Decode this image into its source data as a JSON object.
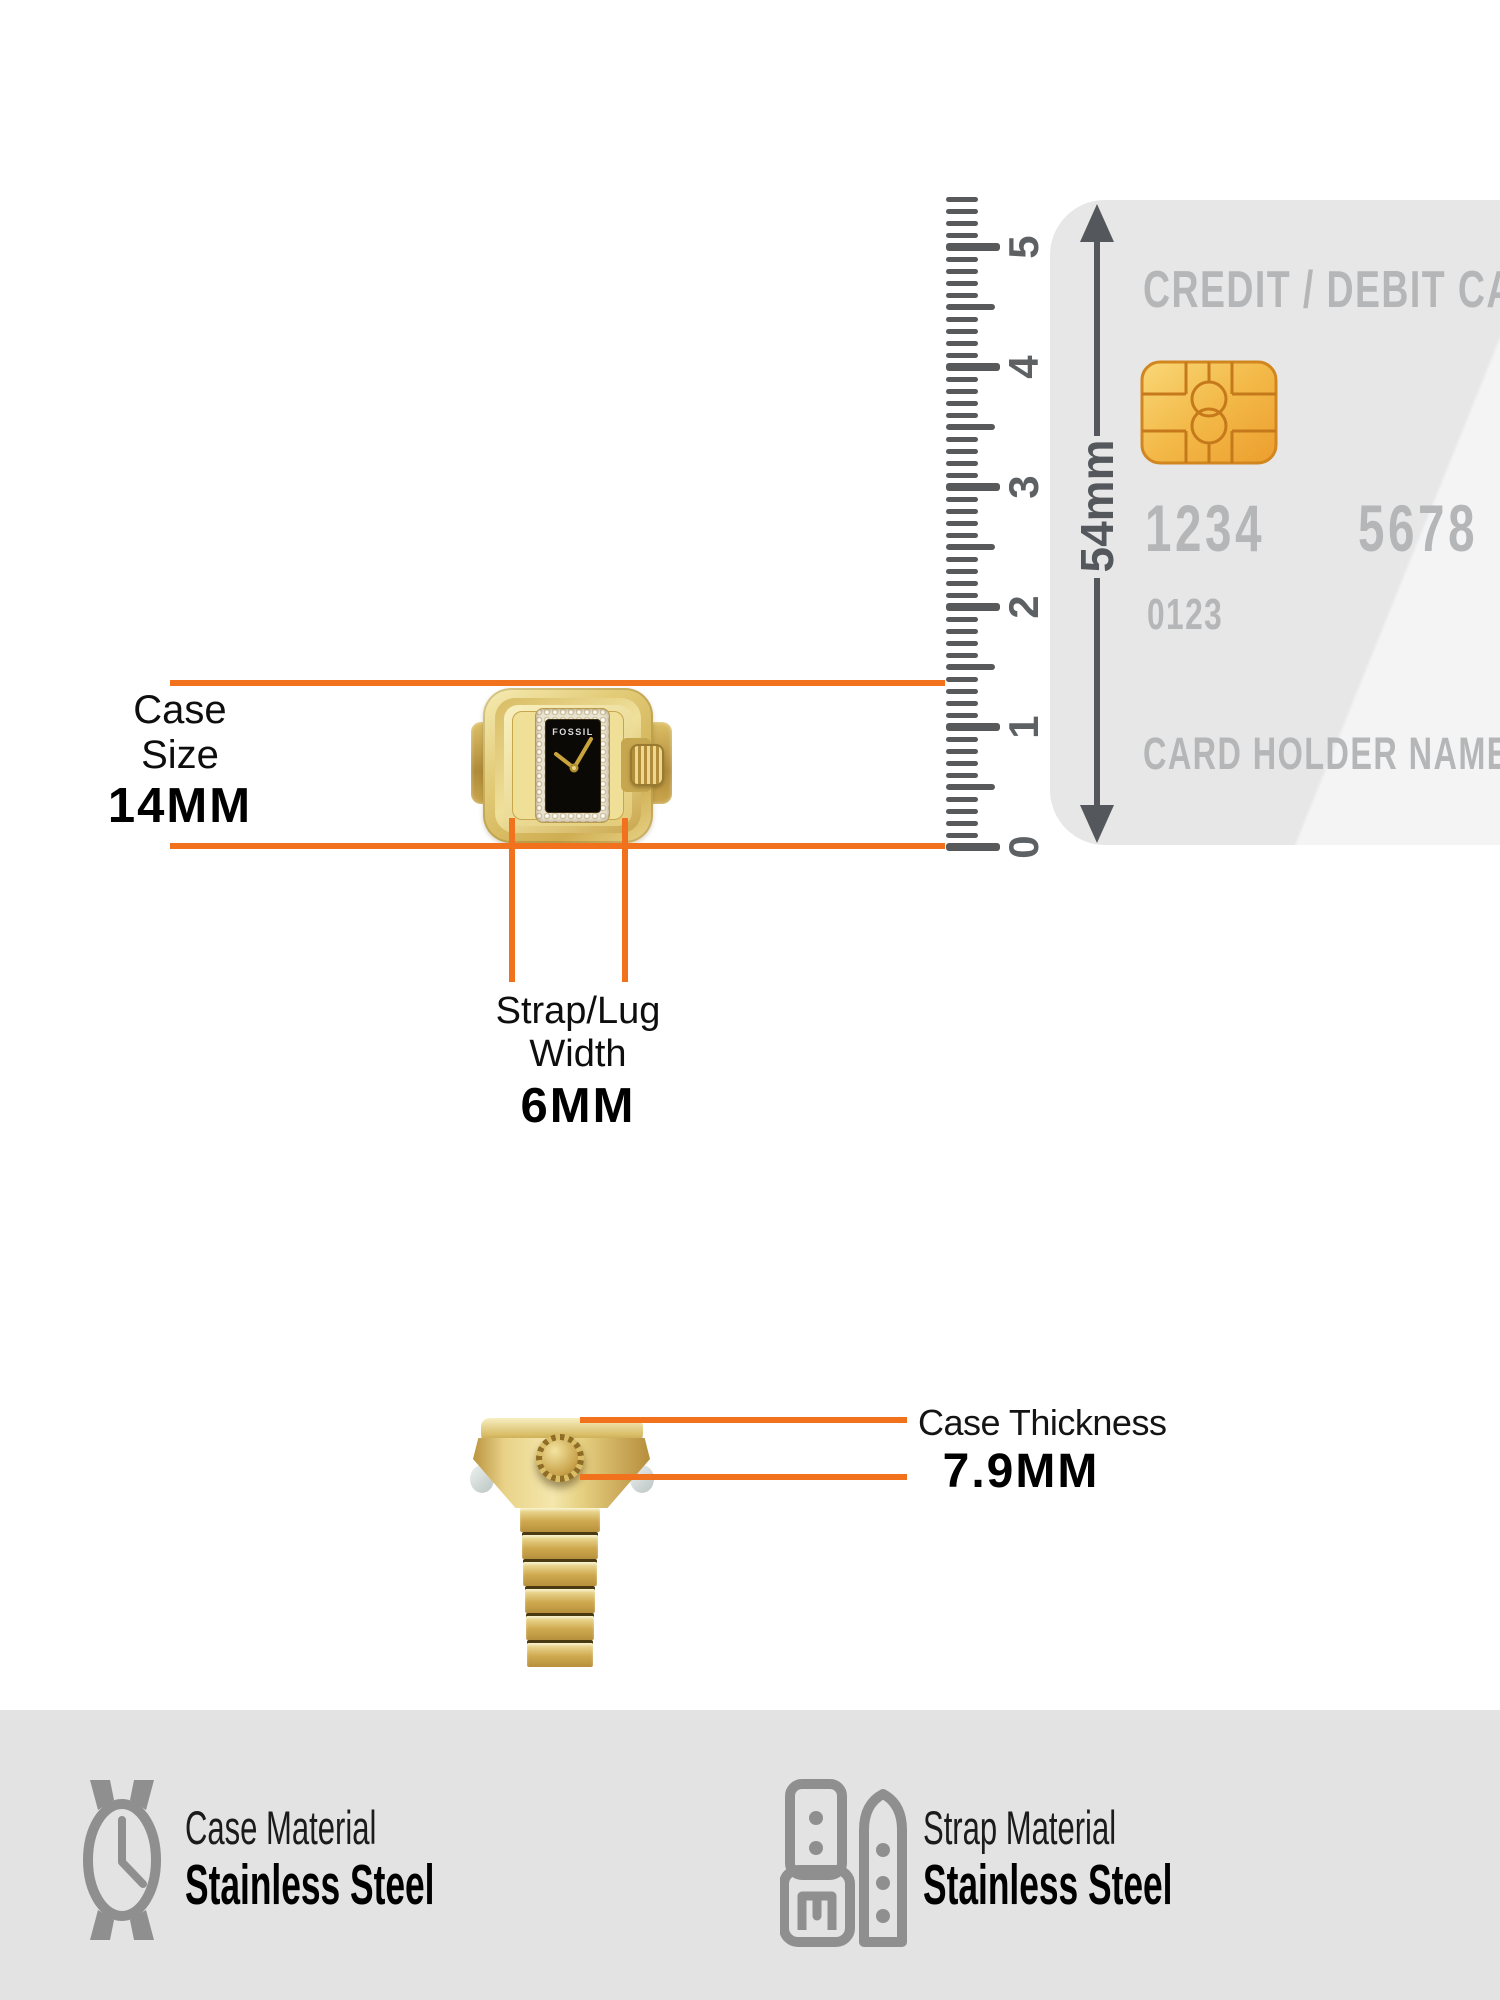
{
  "colors": {
    "accent": "#F2711C",
    "arrow_gray": "#54585C",
    "card_background": "#E7E7E7",
    "card_text": "#B5B6B8",
    "footer_background": "#E3E3E3",
    "icon_gray": "#8F8F8F",
    "watch_gold": "#D9BD66"
  },
  "ruler": {
    "unit": "cm",
    "numbers": [
      "0",
      "1",
      "2",
      "3",
      "4",
      "5"
    ],
    "tick_count_mm": 54
  },
  "card": {
    "title": "CREDIT / DEBIT CARD",
    "chip_icon": "emv-chip-icon",
    "number_left": "1234",
    "number_right": "5678",
    "secondary_number": "0123",
    "holder_label": "CARD HOLDER NAME",
    "height_label": "54mm"
  },
  "watch": {
    "brand": "FOSSIL"
  },
  "measurements": {
    "case_size": {
      "label": [
        "Case",
        "Size"
      ],
      "value": "14MM"
    },
    "strap_lug_width": {
      "label": [
        "Strap/Lug",
        "Width"
      ],
      "value": "6MM"
    },
    "case_thickness": {
      "label": "Case Thickness",
      "value": "7.9MM"
    }
  },
  "materials": {
    "case": {
      "label": "Case Material",
      "value": "Stainless Steel"
    },
    "strap": {
      "label": "Strap Material",
      "value": "Stainless Steel"
    }
  }
}
